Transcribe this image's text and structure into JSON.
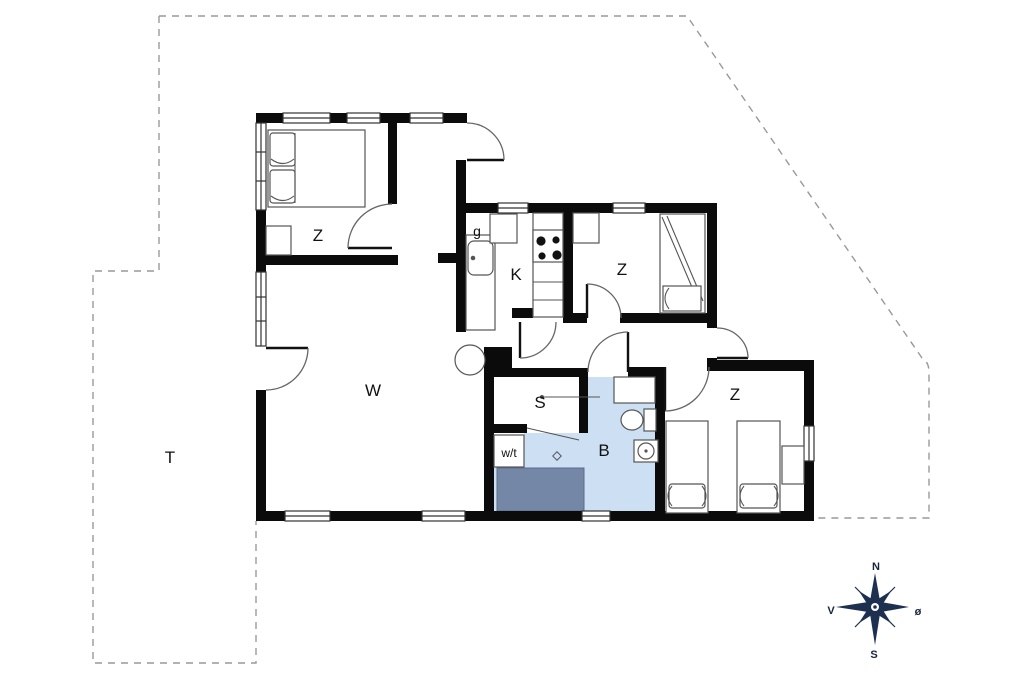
{
  "floorplan": {
    "labels": {
      "bedroom1": "Z",
      "bedroom2": "Z",
      "bedroom3": "Z",
      "kitchen": "K",
      "entry": "g",
      "living": "W",
      "sauna": "S",
      "bath": "B",
      "washer": "w/t",
      "terrace": "T"
    },
    "compass": {
      "north": "N",
      "south": "S",
      "west": "V",
      "east": "ø"
    },
    "colors": {
      "wall": "#0b0b0b",
      "bath_fill": "#cddff2",
      "shower_fill": "#7587a7",
      "compass": "#1e3050"
    }
  }
}
